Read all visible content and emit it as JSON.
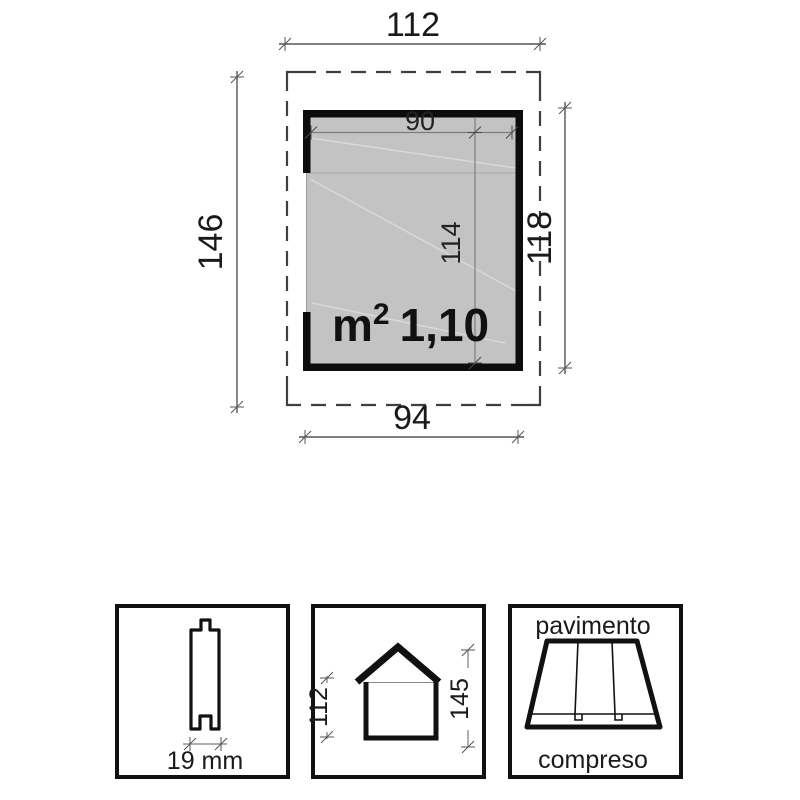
{
  "plan": {
    "overall_width": "112",
    "overall_depth": "146",
    "inner_width": "90",
    "inner_depth": "114",
    "wall_depth": "118",
    "base_width": "94",
    "area_unit": "m",
    "area_exponent": "2",
    "area_value": "1,10"
  },
  "details": {
    "plank_thickness": "19 mm",
    "eave_height": "112",
    "ridge_height": "145",
    "floor_label_top": "pavimento",
    "floor_label_bottom": "compreso"
  },
  "colors": {
    "line": "#1a1a1a",
    "dimension_line": "#555555",
    "interior_fill": "#c3c3c3",
    "background": "#ffffff"
  }
}
